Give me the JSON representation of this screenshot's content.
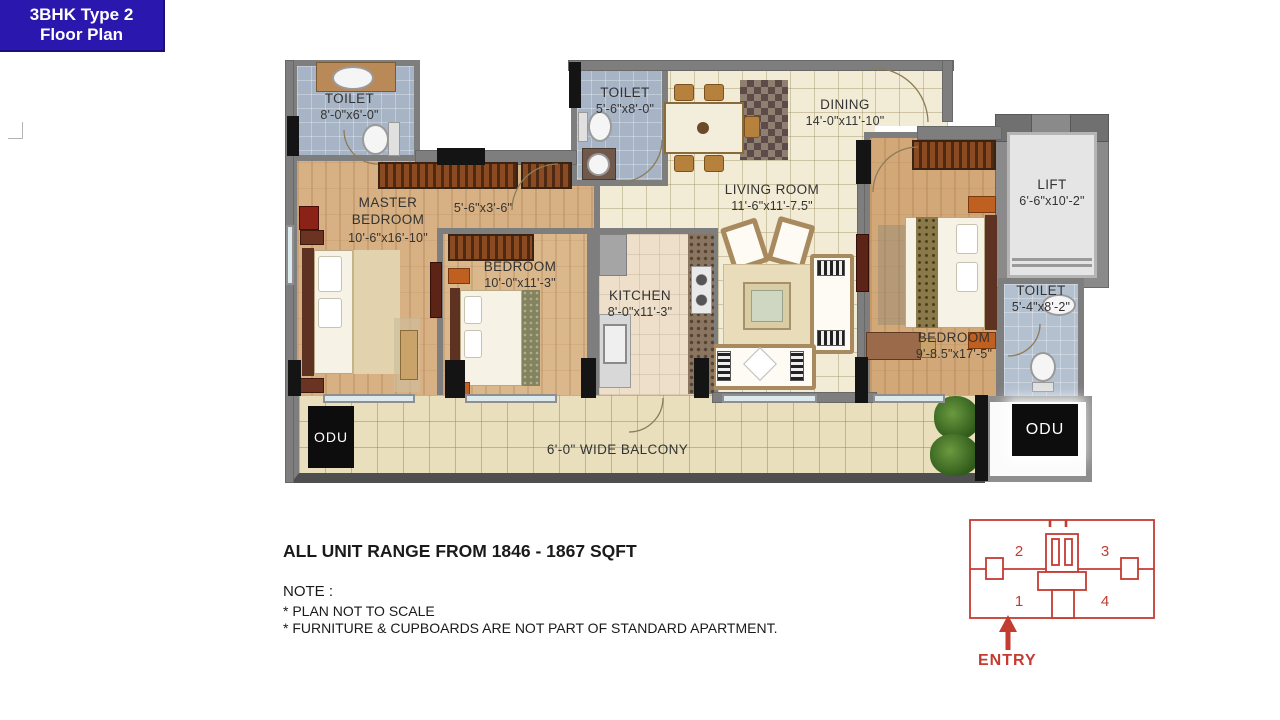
{
  "title_badge": {
    "line1": "3BHK Type 2",
    "line2": "Floor Plan",
    "bg": "#2a18ae"
  },
  "plan": {
    "toilet_master": {
      "name": "TOILET",
      "dim": "8'-0\"x6'-0\""
    },
    "toilet_common": {
      "name": "TOILET",
      "dim": "5'-6\"x8'-0\""
    },
    "dining": {
      "name": "DINING",
      "dim": "14'-0\"x11'-10\""
    },
    "master_bedroom": {
      "name": "MASTER BEDROOM",
      "dim": "10'-6\"x16'-10\""
    },
    "passage": {
      "dim": "5'-6\"x3'-6\""
    },
    "living_room": {
      "name": "LIVING ROOM",
      "dim": "11'-6\"x11'-7.5\""
    },
    "bedroom_2": {
      "name": "BEDROOM",
      "dim": "10'-0\"x11'-3\""
    },
    "kitchen": {
      "name": "KITCHEN",
      "dim": "8'-0\"x11'-3\""
    },
    "lift": {
      "name": "LIFT",
      "dim": "6'-6\"x10'-2\""
    },
    "toilet_3": {
      "name": "TOILET",
      "dim": "5'-4\"x8'-2\""
    },
    "bedroom_3": {
      "name": "BEDROOM",
      "dim": "9'-8.5\"x17'-5\""
    },
    "balcony": {
      "label": "6'-0\" WIDE BALCONY"
    },
    "odu_left": {
      "label": "ODU"
    },
    "odu_right": {
      "label": "ODU"
    }
  },
  "footer": {
    "range": "ALL UNIT RANGE FROM 1846 - 1867 SQFT",
    "note_title": "NOTE :",
    "note1": "* PLAN NOT TO SCALE",
    "note2": "* FURNITURE & CUPBOARDS ARE NOT PART OF STANDARD APARTMENT."
  },
  "key_plan": {
    "unit1": "1",
    "unit2": "2",
    "unit3": "3",
    "unit4": "4",
    "entry": "ENTRY",
    "color": "#c43b32"
  }
}
